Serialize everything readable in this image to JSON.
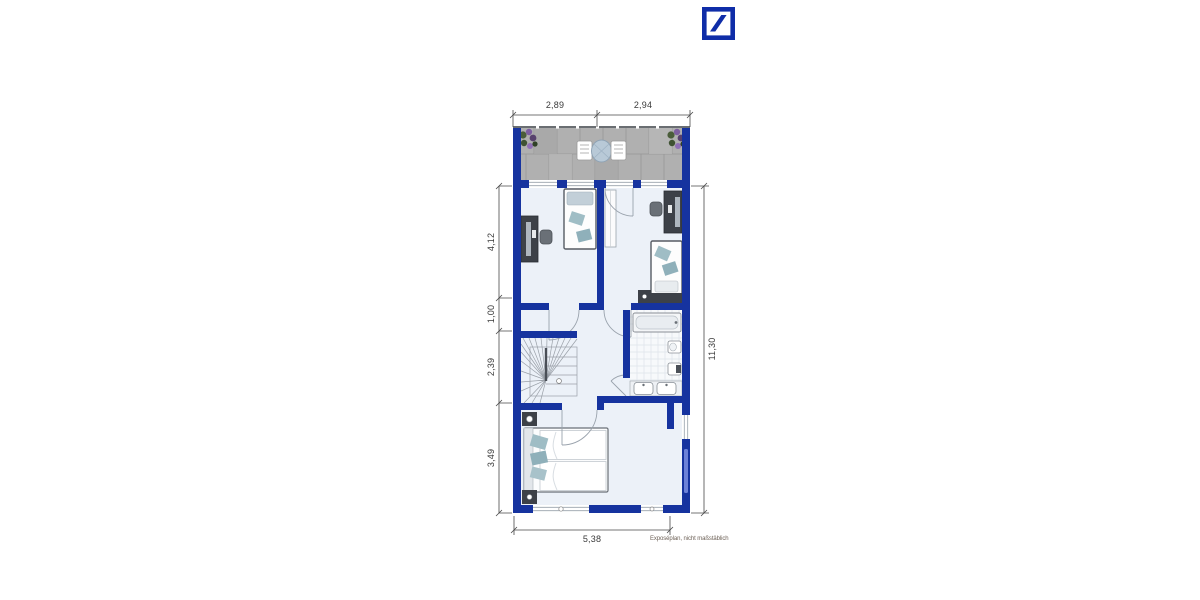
{
  "brand": {
    "logo_icon": "deutsche-bank-slash-square",
    "logo_color": "#0F2DA8"
  },
  "plan": {
    "disclaimer": "Exposéplan, nicht maßstäblich",
    "colors": {
      "wall": "#16339F",
      "floor": "#ECF1F8",
      "balcony_tiles": "#B0B0B0",
      "furniture_dark": "#3D4148",
      "textile_teal": "#9FBDC5",
      "dimension_line": "#4A4A4A",
      "dimension_text": "#3A3A3A"
    },
    "dimensions": {
      "top": [
        {
          "label": "2,89"
        },
        {
          "label": "2,94"
        }
      ],
      "left": [
        {
          "label": "4,12"
        },
        {
          "label": "1,00"
        },
        {
          "label": "2,39"
        },
        {
          "label": "3,49"
        }
      ],
      "right": [
        {
          "label": "11,30"
        }
      ],
      "bottom": [
        {
          "label": "5,38"
        }
      ]
    },
    "icons": {
      "balcony": [
        "plant-icon",
        "table-icon",
        "chair-icon"
      ],
      "rooms": [
        "desk-icon",
        "office-chair-icon",
        "single-bed-icon",
        "wardrobe-icon"
      ],
      "bathroom": [
        "bathtub-icon",
        "toilet-icon",
        "sink-icon"
      ],
      "bedroom": [
        "double-bed-icon",
        "nightstand-icon"
      ],
      "circulation": [
        "stairs-icon",
        "door-arc"
      ]
    }
  }
}
